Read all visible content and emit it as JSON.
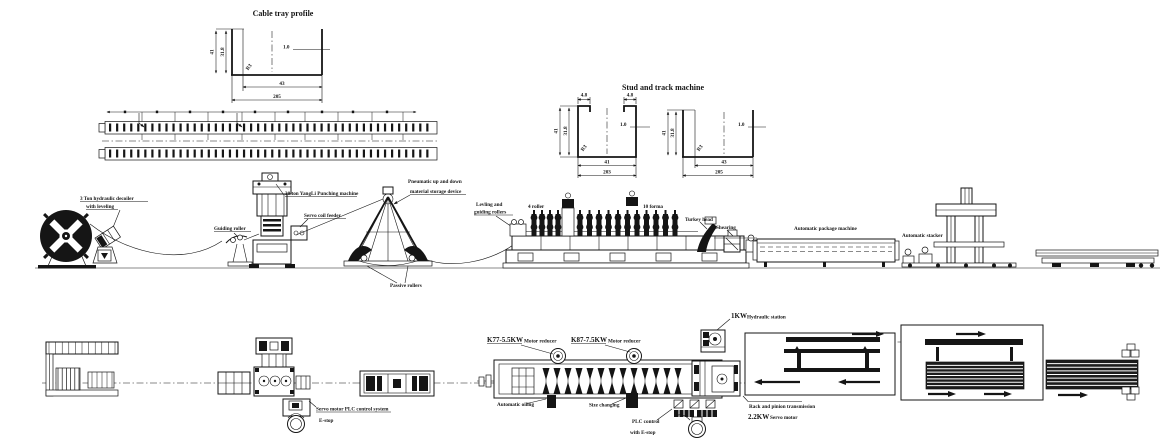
{
  "titles": {
    "cable_tray": "Cable tray profile",
    "stud_track": "Stud and track machine"
  },
  "dims": {
    "ct_h": "41",
    "ct_ih": "31.8",
    "ct_r": "R3",
    "ct_t": "1.0",
    "ct_w1": "43",
    "ct_w2": "205",
    "st_lip1": "4.8",
    "st_lip2": "4.8",
    "st_h": "41",
    "st_ih": "31.8",
    "st_r": "R3",
    "st_t": "1.0",
    "st_w1": "41",
    "st_w2": "203",
    "tr_h": "41",
    "tr_ih": "31.8",
    "tr_r": "R3",
    "tr_t": "1.0",
    "tr_w1": "43",
    "tr_w2": "205"
  },
  "elev": {
    "decoiler_line1": "3 Ton hydraulic decoiler",
    "decoiler_line2": "with leveling",
    "guiding_roller": "Guiding roller",
    "punching": "30 ton YangLi Punching machine",
    "servo_feeder": "Servo coil feeder",
    "storage_line1": "Pneumatic up and down",
    "storage_line2": "material storage device",
    "passive_rollers": "Passive rollers",
    "leveling_line1": "Levling and",
    "leveling_line2": "guiding rollers",
    "four_roller": "4 roller",
    "ten_forma": "10 forma",
    "turkey_head": "Turkey head",
    "shearing": "Shearing",
    "package": "Automatic package machine",
    "stacker": "Automatic stacker"
  },
  "plan": {
    "servo_plc": "Servo motor PLC control system",
    "estop": "E-stop",
    "k77": "K77-5.5KW",
    "k77_sub": "Motor reducer",
    "k87": "K87-7.5KW",
    "k87_sub": "Motor reducer",
    "oiling": "Automatic oiling",
    "size_changing": "Size changing",
    "plc_line1": "PLC control",
    "plc_line2": "with E-stop",
    "hyd_kw": "1KW",
    "hyd": "Hydraulic station",
    "rack": "Rack and pinion transmission",
    "servo_kw": "2.2KW",
    "servo_motor": "Servo motor"
  }
}
